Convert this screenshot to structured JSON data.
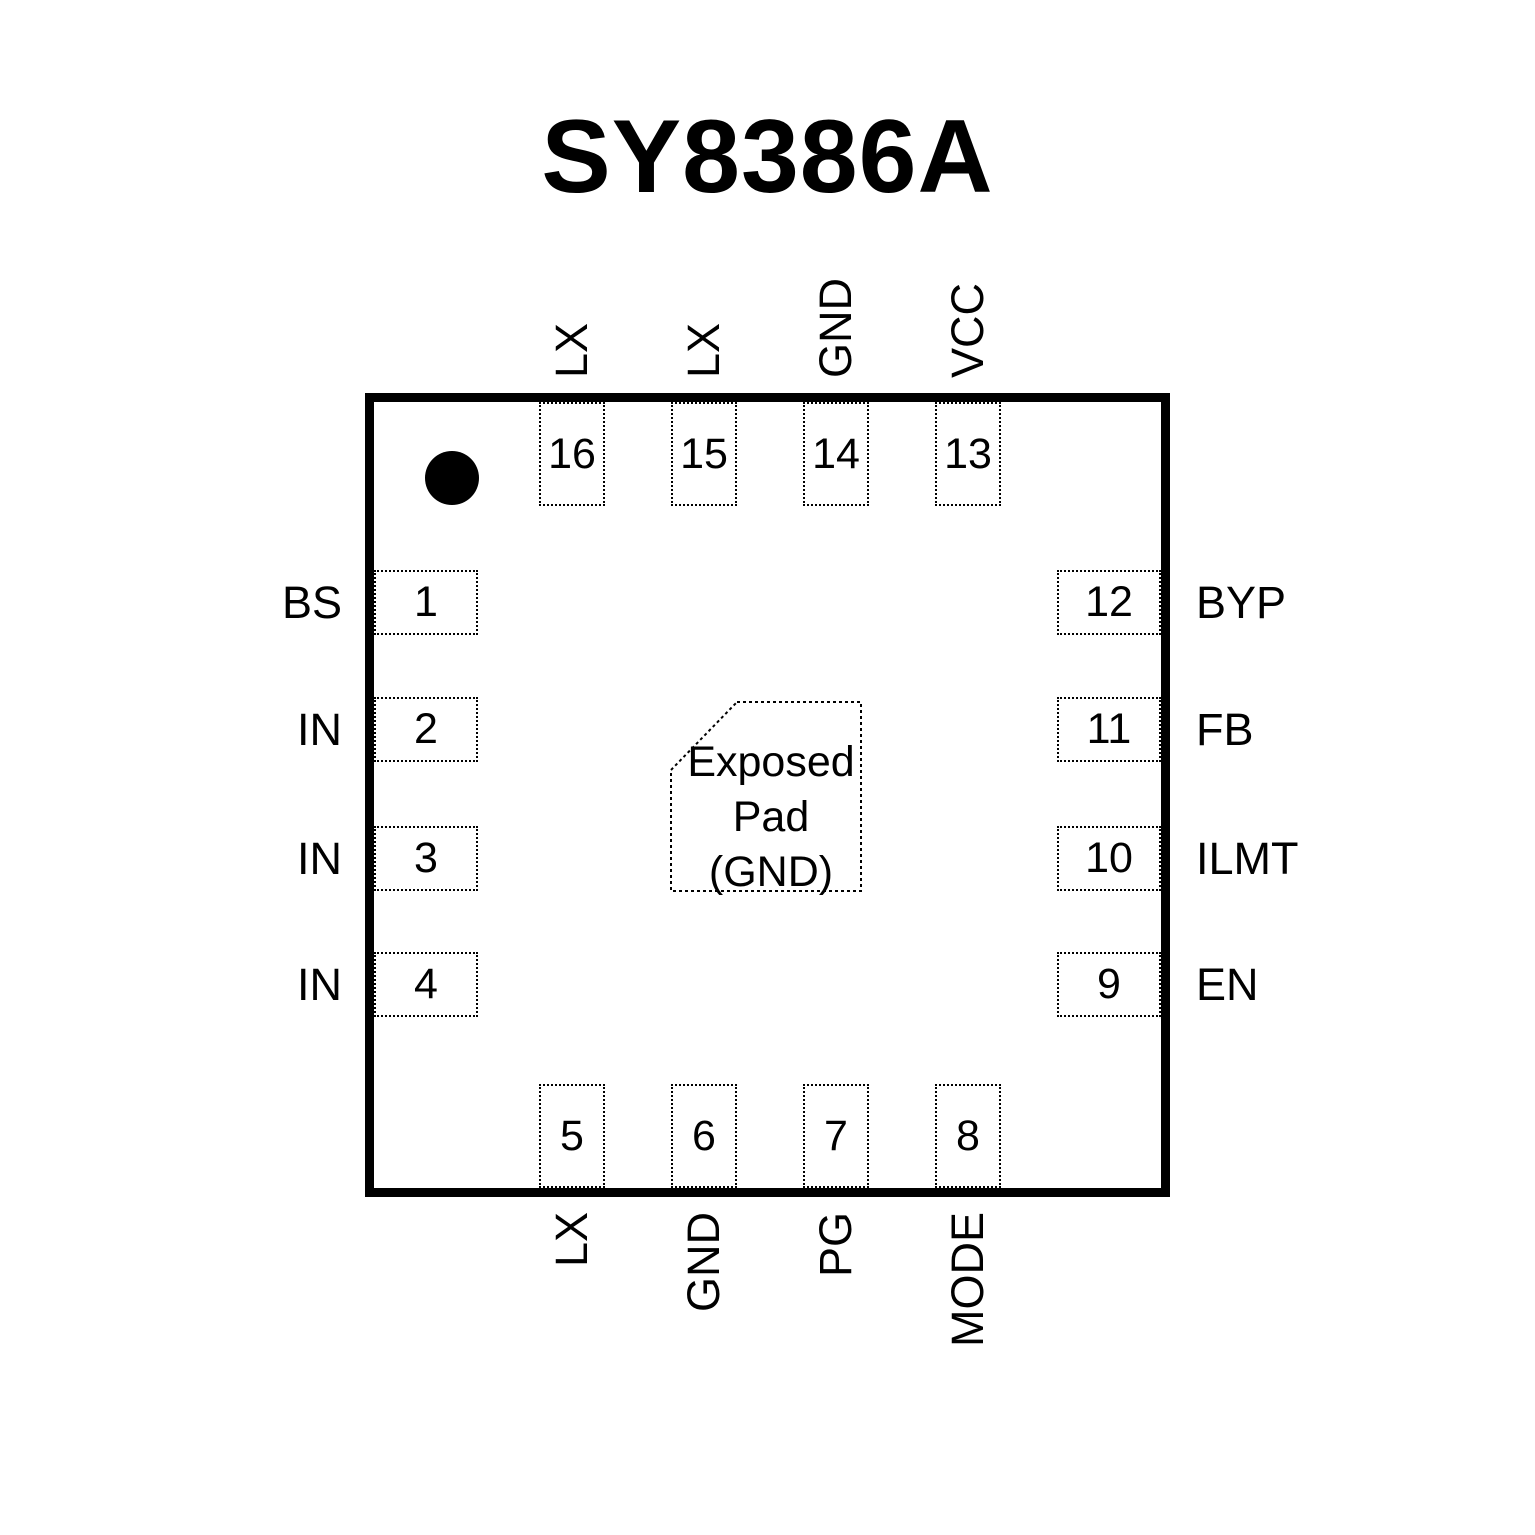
{
  "title": "SY8386A",
  "colors": {
    "ink": "#000000",
    "background": "#ffffff"
  },
  "package": {
    "type": "QFN-16 pinout (top view)"
  },
  "exposed_pad": {
    "line1": "Exposed",
    "line2": "Pad",
    "line3": "(GND)"
  },
  "pins": {
    "top": [
      {
        "number": "16",
        "name": "LX"
      },
      {
        "number": "15",
        "name": "LX"
      },
      {
        "number": "14",
        "name": "GND"
      },
      {
        "number": "13",
        "name": "VCC"
      }
    ],
    "bottom": [
      {
        "number": "5",
        "name": "LX"
      },
      {
        "number": "6",
        "name": "GND"
      },
      {
        "number": "7",
        "name": "PG"
      },
      {
        "number": "8",
        "name": "MODE"
      }
    ],
    "left": [
      {
        "number": "1",
        "name": "BS"
      },
      {
        "number": "2",
        "name": "IN"
      },
      {
        "number": "3",
        "name": "IN"
      },
      {
        "number": "4",
        "name": "IN"
      }
    ],
    "right": [
      {
        "number": "12",
        "name": "BYP"
      },
      {
        "number": "11",
        "name": "FB"
      },
      {
        "number": "10",
        "name": "ILMT"
      },
      {
        "number": "9",
        "name": "EN"
      }
    ]
  }
}
